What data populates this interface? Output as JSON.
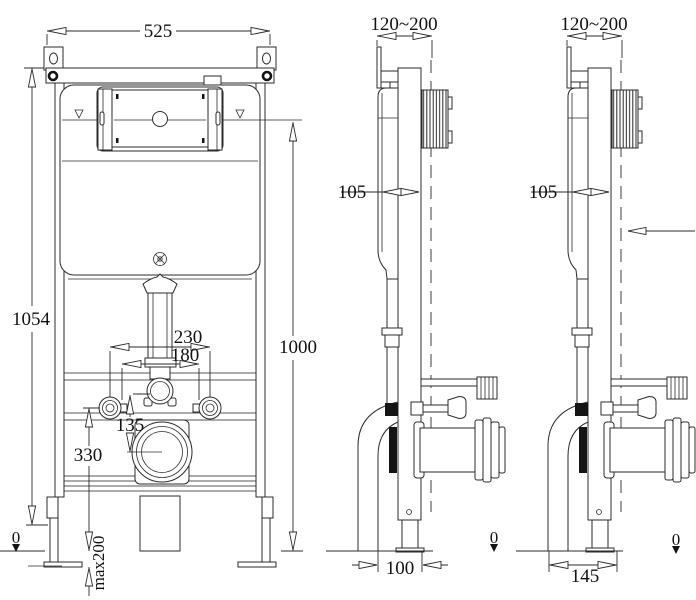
{
  "drawing": {
    "title": "concealed-cistern-frame-dimension-drawing",
    "front": {
      "width": "525",
      "total_height": "1054",
      "flush_height": "1000",
      "spacing_outer": "230",
      "spacing_inner": "180",
      "pipe_offset": "135",
      "outlet_height": "330",
      "floor": "0",
      "leg_adjust": "max200"
    },
    "side_center": {
      "depth_range": "120~200",
      "tank_depth": "105",
      "drain_offset": "100",
      "floor": "0"
    },
    "side_right": {
      "depth_range": "120~200",
      "tank_depth": "105",
      "drain_offset": "145",
      "floor": "0"
    }
  }
}
